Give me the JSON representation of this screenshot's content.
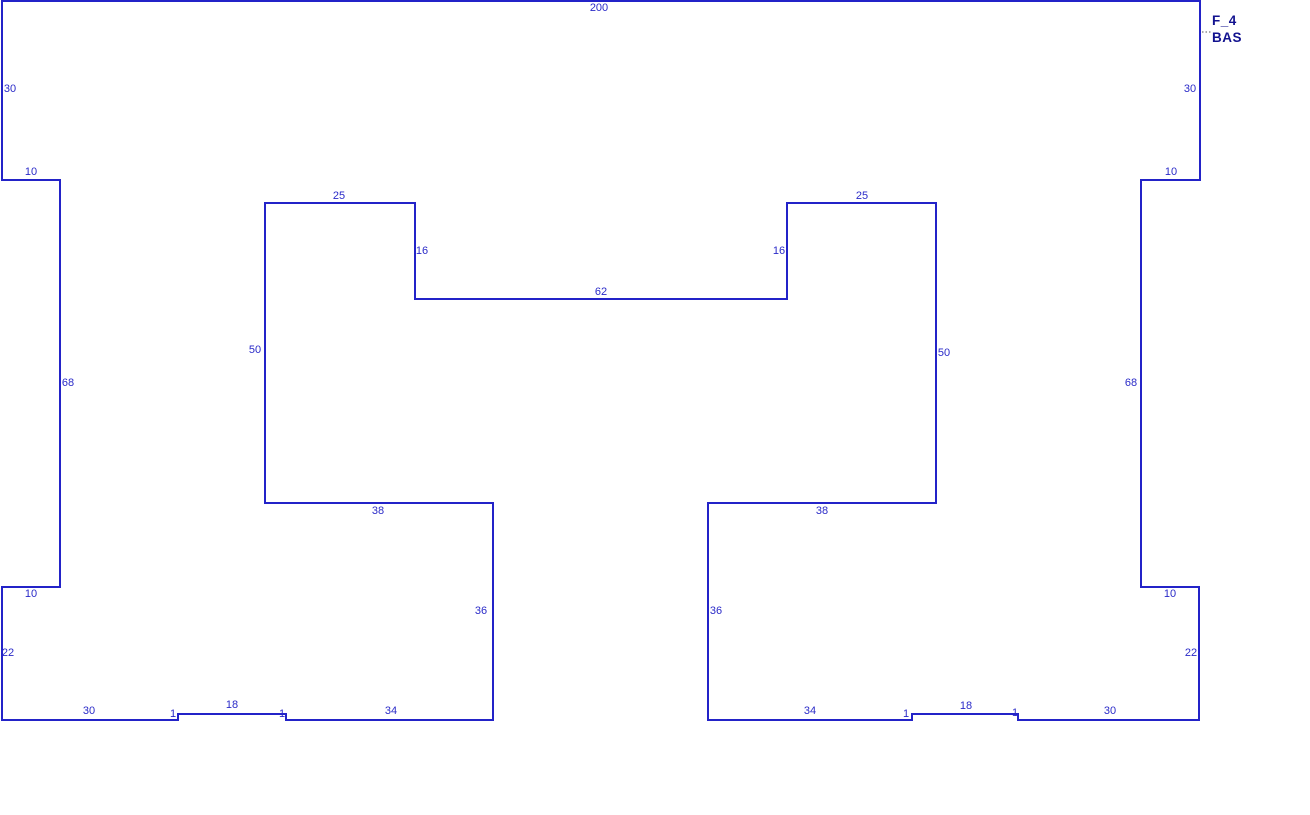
{
  "drawing": {
    "part_label": {
      "line1": "F_4",
      "line2": "BAS"
    },
    "colors": {
      "background": "#ffffff",
      "outline": "#2323c8",
      "dimension_text": "#2a2ac8",
      "part_label_text": "#12128f",
      "leader_dots": "#909090"
    },
    "outline_points": [
      [
        2,
        1
      ],
      [
        1200,
        1
      ],
      [
        1200,
        180
      ],
      [
        1141,
        180
      ],
      [
        1141,
        587
      ],
      [
        1199,
        587
      ],
      [
        1199,
        720
      ],
      [
        1018,
        720
      ],
      [
        1018,
        714
      ],
      [
        912,
        714
      ],
      [
        912,
        720
      ],
      [
        708,
        720
      ],
      [
        708,
        503
      ],
      [
        936,
        503
      ],
      [
        936,
        203
      ],
      [
        787,
        203
      ],
      [
        787,
        299
      ],
      [
        415,
        299
      ],
      [
        415,
        203
      ],
      [
        265,
        203
      ],
      [
        265,
        503
      ],
      [
        493,
        503
      ],
      [
        493,
        720
      ],
      [
        286,
        720
      ],
      [
        286,
        714
      ],
      [
        178,
        714
      ],
      [
        178,
        720
      ],
      [
        2,
        720
      ],
      [
        2,
        587
      ],
      [
        60,
        587
      ],
      [
        60,
        180
      ],
      [
        2,
        180
      ]
    ],
    "leader": {
      "x1": 1202,
      "y1": 32,
      "x2": 1212,
      "y2": 32
    },
    "dimension_labels": [
      {
        "text": "200",
        "x": 599,
        "y": 8
      },
      {
        "text": "30",
        "x": 10,
        "y": 89
      },
      {
        "text": "10",
        "x": 31,
        "y": 172
      },
      {
        "text": "68",
        "x": 68,
        "y": 383
      },
      {
        "text": "10",
        "x": 31,
        "y": 594
      },
      {
        "text": "22",
        "x": 8,
        "y": 653
      },
      {
        "text": "30",
        "x": 1190,
        "y": 89
      },
      {
        "text": "10",
        "x": 1171,
        "y": 172
      },
      {
        "text": "68",
        "x": 1131,
        "y": 383
      },
      {
        "text": "10",
        "x": 1170,
        "y": 594
      },
      {
        "text": "22",
        "x": 1191,
        "y": 653
      },
      {
        "text": "25",
        "x": 339,
        "y": 196
      },
      {
        "text": "16",
        "x": 422,
        "y": 251
      },
      {
        "text": "50",
        "x": 255,
        "y": 350
      },
      {
        "text": "38",
        "x": 378,
        "y": 511
      },
      {
        "text": "36",
        "x": 481,
        "y": 611
      },
      {
        "text": "25",
        "x": 862,
        "y": 196
      },
      {
        "text": "16",
        "x": 779,
        "y": 251
      },
      {
        "text": "50",
        "x": 944,
        "y": 353
      },
      {
        "text": "38",
        "x": 822,
        "y": 511
      },
      {
        "text": "36",
        "x": 716,
        "y": 611
      },
      {
        "text": "62",
        "x": 601,
        "y": 292
      },
      {
        "text": "30",
        "x": 89,
        "y": 711
      },
      {
        "text": "1",
        "x": 173,
        "y": 714
      },
      {
        "text": "18",
        "x": 232,
        "y": 705
      },
      {
        "text": "1",
        "x": 282,
        "y": 714
      },
      {
        "text": "34",
        "x": 391,
        "y": 711
      },
      {
        "text": "34",
        "x": 810,
        "y": 711
      },
      {
        "text": "1",
        "x": 906,
        "y": 714
      },
      {
        "text": "18",
        "x": 966,
        "y": 706
      },
      {
        "text": "1",
        "x": 1015,
        "y": 713
      },
      {
        "text": "30",
        "x": 1110,
        "y": 711
      }
    ]
  }
}
